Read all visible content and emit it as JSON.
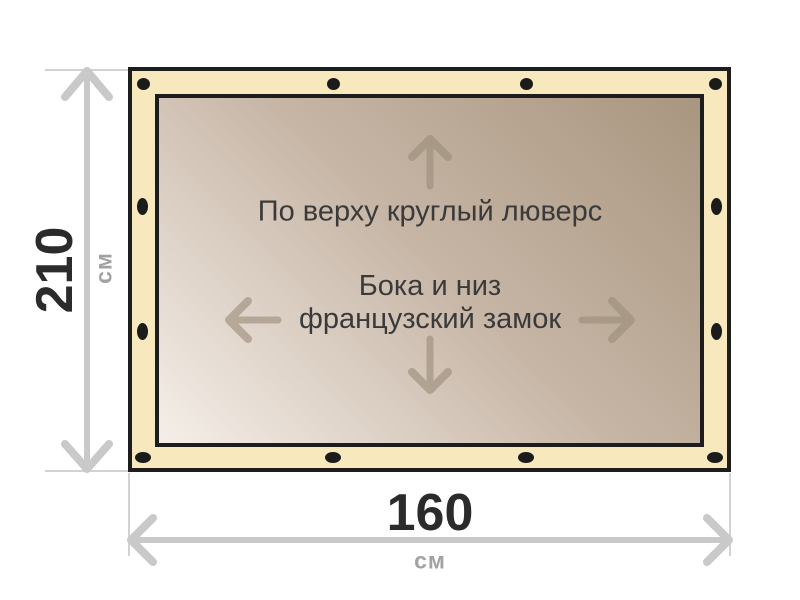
{
  "diagram": {
    "type": "tarp-size-scheme",
    "dimensions": {
      "height": {
        "value": "210",
        "unit": "см"
      },
      "width": {
        "value": "160",
        "unit": "см"
      }
    },
    "annotations": {
      "top_edge": "По верху круглый люверс",
      "sides_line1": "Бока и низ",
      "sides_line2": "французский замок"
    },
    "icons": {
      "grommet": "grommet-dot",
      "inner_arrows": [
        "arrow-up-icon",
        "arrow-left-icon",
        "arrow-right-icon",
        "arrow-down-icon"
      ],
      "dimension_arrows": [
        "dimension-arrow-vertical",
        "dimension-arrow-horizontal"
      ]
    },
    "colors": {
      "background": "#ffffff",
      "frame_fill": "#f8e8bd",
      "frame_stroke": "#1d1d1d",
      "canvas_gradient_light": "#f5efe9",
      "canvas_gradient_dark": "#a99680",
      "grommet": "#1b1b1b",
      "dimension_gray": "#c9c9c9",
      "extension_gray": "#d2d2d2",
      "inner_arrow": "#9c8d7b",
      "value_text": "#2b2b2b",
      "unit_text": "#a2a2a2",
      "annotation_text": "#3a3a3a"
    }
  }
}
